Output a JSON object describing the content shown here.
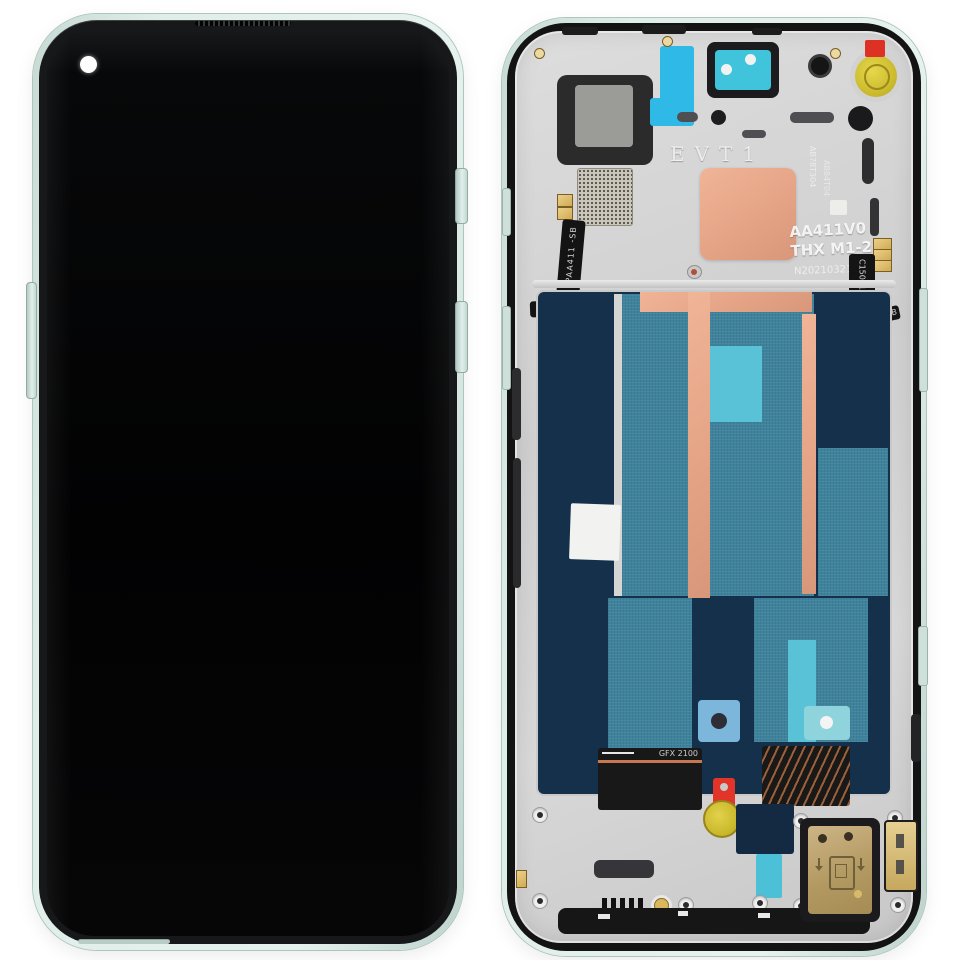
{
  "scene": {
    "background": "#ffffff"
  },
  "front": {
    "frame_color": "#d8e8e3",
    "screen_color": "#060607",
    "bezel_color": "#16181a"
  },
  "back": {
    "etched_stage_code": "EVT1",
    "board_code_line1": "AA411V0",
    "board_code_line2": "THX M1-2",
    "batch_code": "N20210321A",
    "etched_vertical_code_a": "AB78T304",
    "etched_vertical_code_b": "AB84T04",
    "left_flex_vertical_code": "PAA411 -SB",
    "left_flex_horizontal_code": "C150 2110",
    "right_flex_vertical_code": "C1502110",
    "right_flex_label_code": "VAA411-SB",
    "bottom_flex_code": "GFX 2100",
    "colors": {
      "frame": "#d8e8e3",
      "plate": "#d3d3d3",
      "copper_pad": "#e9a98c",
      "navy_panel": "#15304a",
      "teal_panel": "#3e829b",
      "cyan_strip": "#59c2d6",
      "adhesive_blue": "#2fb9e6",
      "warning_red": "#df3127",
      "seal_yellow": "#d3c13a",
      "contact_gold": "#d9a94f"
    }
  }
}
